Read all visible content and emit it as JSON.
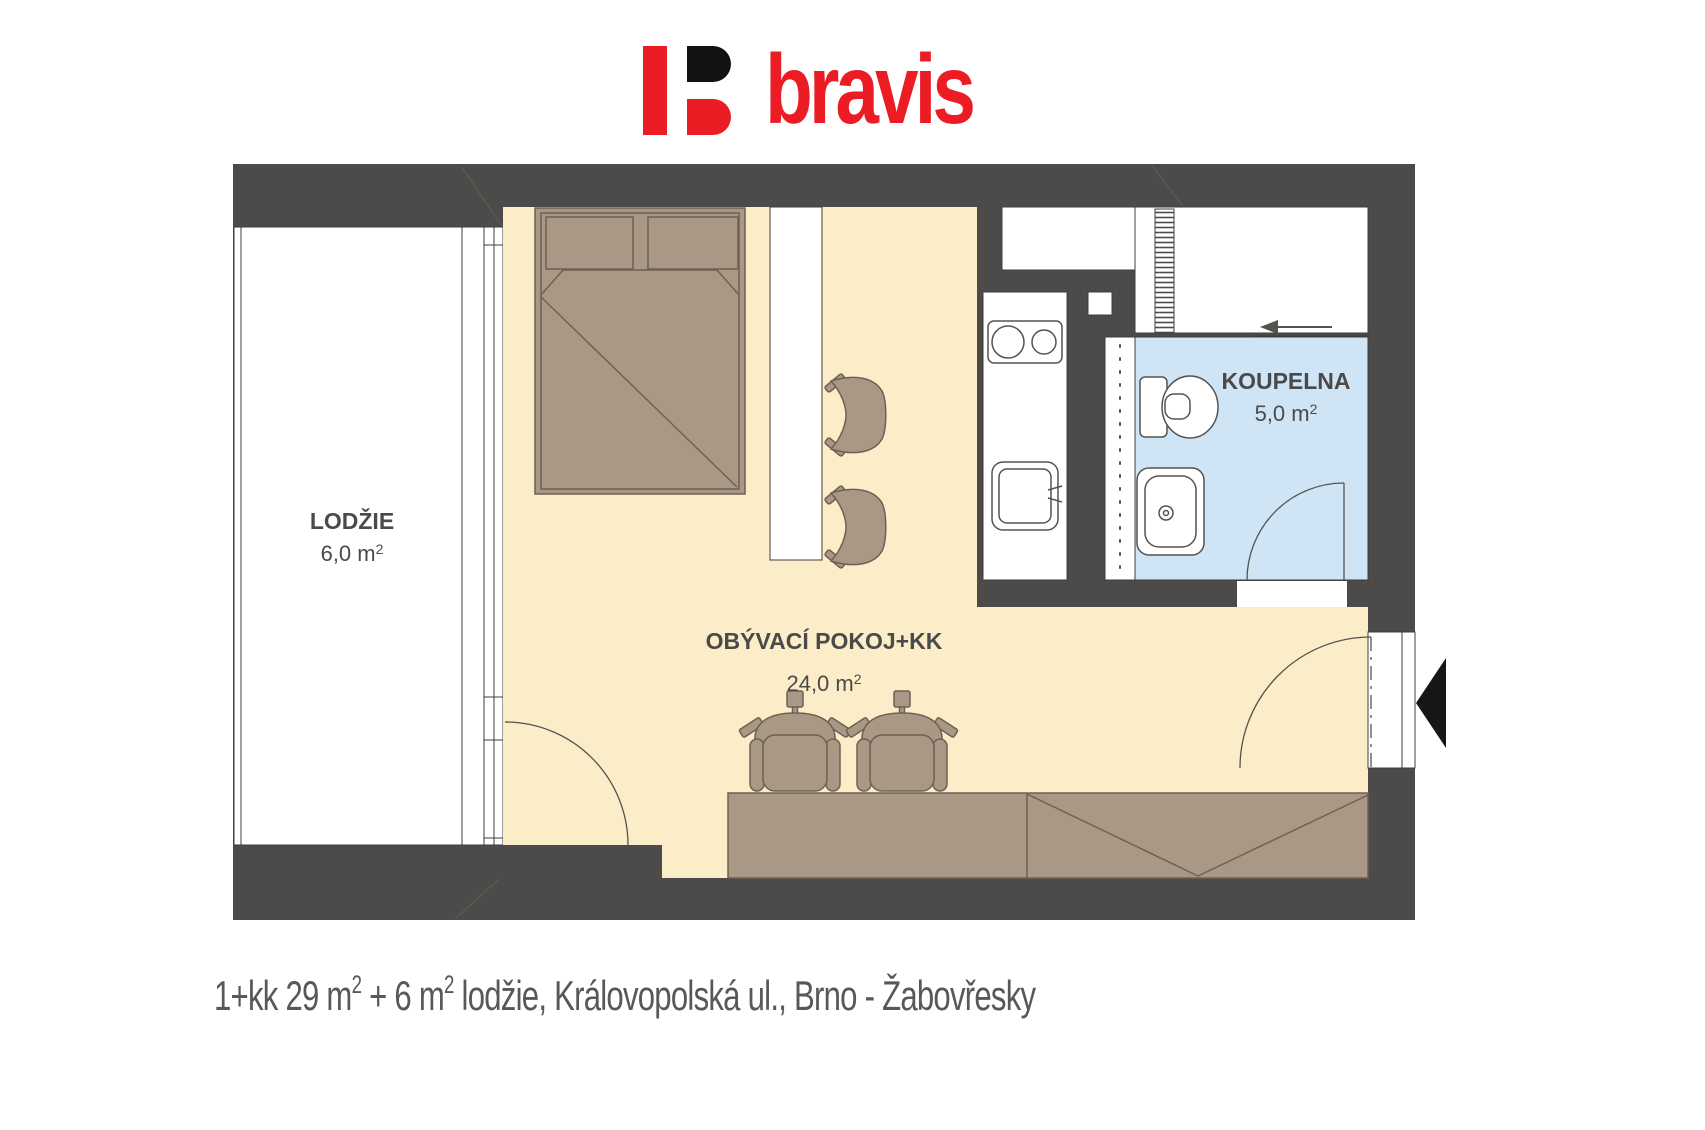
{
  "logo": {
    "brand": "bravis"
  },
  "rooms": {
    "loggia": {
      "label": "LODŽIE",
      "area": "6,0 m",
      "area_sup": "2"
    },
    "living": {
      "label": "OBÝVACÍ POKOJ+KK",
      "area": "24,0 m",
      "area_sup": "2"
    },
    "bathroom": {
      "label": "KOUPELNA",
      "area": "5,0 m",
      "area_sup": "2"
    }
  },
  "caption": {
    "part1": "1+kk 29 m",
    "sup1": "2",
    "part2": " + 6 m",
    "sup2": "2",
    "part3": " lodžie, Královopolská ul., Brno - Žabovřesky"
  },
  "colors": {
    "wall": "#4d4b49",
    "living_floor": "#faedc8",
    "bathroom_floor": "#cfe4f5",
    "furniture": "#a99886",
    "logo_red": "#ec1c24",
    "label_gray": "#4a4a4a",
    "caption_gray": "#58585a"
  }
}
